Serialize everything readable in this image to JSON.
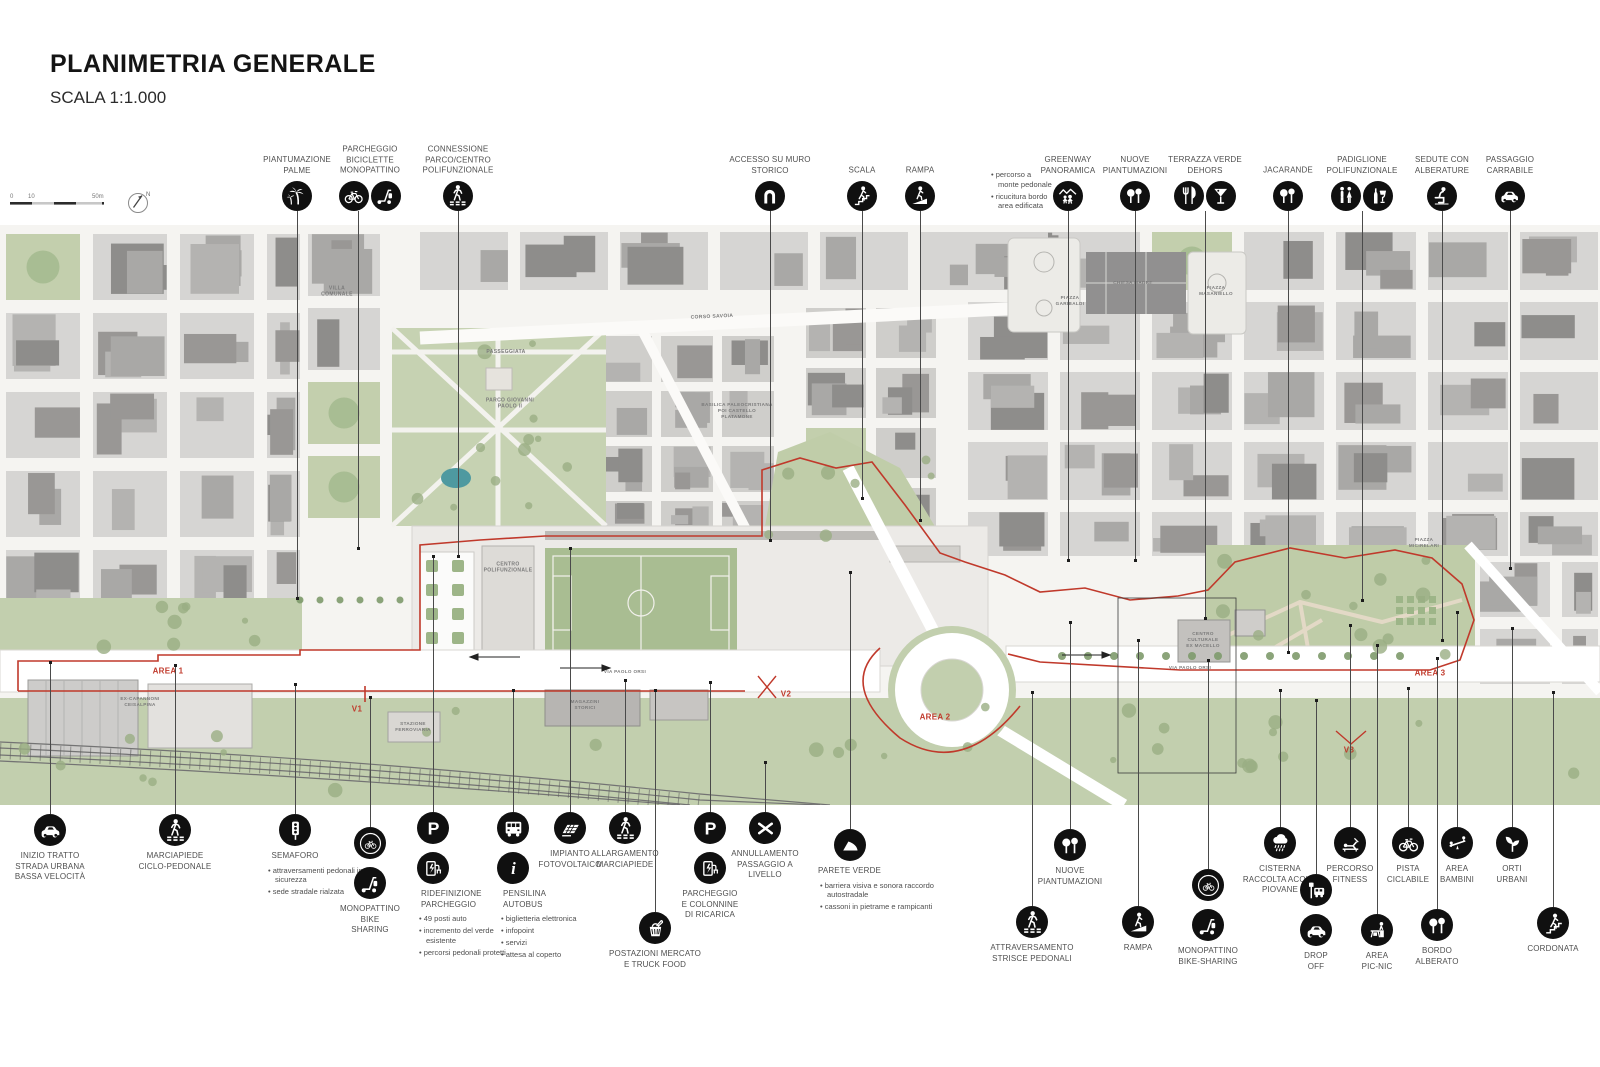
{
  "header": {
    "title": "PLANIMETRIA GENERALE",
    "subtitle": "SCALA 1:1.000"
  },
  "scalebar": {
    "ticks": [
      "0",
      "10",
      "50m"
    ],
    "north": "N"
  },
  "colors": {
    "accent_red": "#c0392b",
    "icon_background": "#101010",
    "map_green": "#c2cfae",
    "pond_teal": "#4e99a0"
  },
  "map_labels": [
    {
      "id": "villa-comunale",
      "text": "VILLA\nCOMUNALE",
      "x": 337,
      "y": 292,
      "size": 5
    },
    {
      "id": "passeggiata",
      "text": "PASSEGGIATA",
      "x": 506,
      "y": 352,
      "size": 5
    },
    {
      "id": "parco-giovanni-paolo",
      "text": "PARCO GIOVANNI\nPAOLO II",
      "x": 510,
      "y": 404,
      "size": 5
    },
    {
      "id": "corso-savoia",
      "text": "CORSO SAVOIA",
      "x": 712,
      "y": 317,
      "size": 5,
      "rotate": -2.5
    },
    {
      "id": "basilica-paleocristiana",
      "text": "BASILICA PALEOCRISTIANA\nPOI CASTELLO\nPLATAMONE",
      "x": 737,
      "y": 411,
      "size": 4.6
    },
    {
      "id": "piazza-garibaldi",
      "text": "PIAZZA\nGARIBALDI",
      "x": 1070,
      "y": 301,
      "size": 4.6
    },
    {
      "id": "chiesa-madre",
      "text": "CHIESA MADRE",
      "x": 1133,
      "y": 283,
      "size": 4.6
    },
    {
      "id": "piazza-masaniello",
      "text": "PIAZZA\nMASANIELLO",
      "x": 1216,
      "y": 291,
      "size": 4.6
    },
    {
      "id": "centro-polifunzionale",
      "text": "CENTRO\nPOLIFUNZIONALE",
      "x": 508,
      "y": 568,
      "size": 5
    },
    {
      "id": "via-paolo-orsi-ovest",
      "text": "VIA PAOLO ORSI",
      "x": 625,
      "y": 672,
      "size": 4.6
    },
    {
      "id": "via-paolo-orsi-est",
      "text": "VIA PAOLO ORSI",
      "x": 1190,
      "y": 668,
      "size": 4.6
    },
    {
      "id": "magazzini-storici",
      "text": "MAGAZZINI\nSTORICI",
      "x": 585,
      "y": 705,
      "size": 4.6
    },
    {
      "id": "stazione-ferroviaria",
      "text": "STAZIONE\nFERROVIARIA",
      "x": 413,
      "y": 727,
      "size": 4.6
    },
    {
      "id": "ex-capannoni",
      "text": "EX-CAPANNONI\nCEISALPINA",
      "x": 140,
      "y": 702,
      "size": 4.6
    },
    {
      "id": "centro-culturale-ex-macello",
      "text": "CENTRO\nCULTURALE\nEX MACELLO",
      "x": 1203,
      "y": 640,
      "size": 4.6
    },
    {
      "id": "piazza-micirelari",
      "text": "PIAZZA\nMICIRELARI",
      "x": 1424,
      "y": 543,
      "size": 4.6
    }
  ],
  "red_labels": [
    {
      "id": "area-1",
      "text": "AREA 1",
      "x": 168,
      "y": 671
    },
    {
      "id": "area-2",
      "text": "AREA 2",
      "x": 935,
      "y": 717
    },
    {
      "id": "area-3",
      "text": "AREA 3",
      "x": 1430,
      "y": 673
    },
    {
      "id": "v1",
      "text": "V1",
      "x": 357,
      "y": 709
    },
    {
      "id": "v2",
      "text": "V2",
      "x": 786,
      "y": 694
    },
    {
      "id": "v3",
      "text": "V3",
      "x": 1349,
      "y": 750
    }
  ],
  "callouts_top": [
    {
      "id": "piantumazione-palme",
      "label": "PIANTUMAZIONE\nPALME",
      "icons": [
        "palm"
      ],
      "x": 297,
      "line_to": 598
    },
    {
      "id": "parcheggio-biciclette-monopattino",
      "label": "PARCHEGGIO\nBICICLETTE\nMONOPATTINO",
      "icons": [
        "bike",
        "scooter"
      ],
      "x": 370,
      "lx": 358,
      "line_to": 548
    },
    {
      "id": "connessione-parco-centro",
      "label": "CONNESSIONE\nPARCO/CENTRO\nPOLIFUNZIONALE",
      "icons": [
        "crosswalk"
      ],
      "x": 458,
      "line_to": 556
    },
    {
      "id": "accesso-su-muro-storico",
      "label": "ACCESSO SU MURO\nSTORICO",
      "icons": [
        "arch"
      ],
      "x": 770,
      "line_to": 540
    },
    {
      "id": "scala",
      "label": "SCALA",
      "icons": [
        "stairs"
      ],
      "x": 862,
      "line_to": 498
    },
    {
      "id": "rampa",
      "label": "RAMPA",
      "icons": [
        "ramp"
      ],
      "x": 920,
      "line_to": 520
    },
    {
      "id": "greenway-panoramica",
      "label": "GREENWAY\nPANORAMICA",
      "icons": [
        "greenway"
      ],
      "x": 1068,
      "line_to": 560,
      "bullets": [
        "percorso a monte pedonale",
        "ricucitura bordo area edificata"
      ],
      "bullets_side": "left"
    },
    {
      "id": "nuove-piantumazioni-nord",
      "label": "NUOVE\nPIANTUMAZIONI",
      "icons": [
        "trees"
      ],
      "x": 1135,
      "line_to": 560
    },
    {
      "id": "terrazza-verde-dehors",
      "label": "TERRAZZA VERDE\nDEHORS",
      "icons": [
        "forkknife",
        "martini"
      ],
      "x": 1205,
      "line_to": 618
    },
    {
      "id": "jacarande",
      "label": "JACARANDE",
      "icons": [
        "trees"
      ],
      "x": 1288,
      "line_to": 652
    },
    {
      "id": "padiglione-polifunzionale",
      "label": "PADIGLIONE\nPOLIFUNZIONALE",
      "icons": [
        "wc",
        "bottleglass"
      ],
      "x": 1362,
      "line_to": 600
    },
    {
      "id": "sedute-con-alberature",
      "label": "SEDUTE CON\nALBERATURE",
      "icons": [
        "sit"
      ],
      "x": 1442,
      "line_to": 640
    },
    {
      "id": "passaggio-carrabile",
      "label": "PASSAGGIO\nCARRABILE",
      "icons": [
        "car"
      ],
      "x": 1510,
      "line_to": 568
    }
  ],
  "callouts_bottom": [
    {
      "id": "inizio-tratto-strada-urbana",
      "label": "INIZIO TRATTO\nSTRADA URBANA\nBASSA VELOCITÀ",
      "icons": [
        "car"
      ],
      "x": 50,
      "iy": 830,
      "line_from": 662
    },
    {
      "id": "marciapiede-ciclo-pedonale",
      "label": "MARCIAPIEDE\nCICLO-PEDONALE",
      "icons": [
        "crosswalk"
      ],
      "x": 175,
      "iy": 830,
      "line_from": 665
    },
    {
      "id": "semaforo",
      "label": "SEMAFORO",
      "icons": [
        "traffic"
      ],
      "x": 295,
      "iy": 830,
      "line_from": 684,
      "bullets": [
        "attraversamenti pedonali in sicurezza",
        "sede stradale rialzata"
      ],
      "bx": -27,
      "bw": 112
    },
    {
      "id": "monopattino-bike-sharing",
      "label": "MONOPATTINO\nBIKE\nSHARING",
      "icons": [
        "bikeshare",
        "scooter"
      ],
      "x": 370,
      "iy": 843,
      "line_from": 697
    },
    {
      "id": "ridefinizione-parcheggio",
      "label": "RIDEFINIZIONE\nPARCHEGGIO",
      "icons": [
        "parkP",
        "charge"
      ],
      "x": 433,
      "iy": 828,
      "line_from": 556,
      "align": "left",
      "ldx": -12,
      "bullets": [
        "49 posti auto",
        "incremento del verde esistente",
        "percorsi pedonali protetti"
      ],
      "bx": -14,
      "bw": 100
    },
    {
      "id": "pensilina-autobus",
      "label": "PENSILINA\nAUTOBUS",
      "icons": [
        "bus",
        "info"
      ],
      "x": 513,
      "iy": 828,
      "line_from": 690,
      "align": "left",
      "ldx": -10,
      "bullets": [
        "biglietteria elettronica",
        "infopoint",
        "servizi",
        "attesa al coperto"
      ],
      "bx": -12,
      "bw": 105
    },
    {
      "id": "impianto-fotovoltaico",
      "label": "IMPIANTO\nFOTOVOLTAICO",
      "icons": [
        "solar"
      ],
      "x": 570,
      "iy": 828,
      "line_from": 548
    },
    {
      "id": "allargamento-marciapiede",
      "label": "ALLARGAMENTO\nMARCIAPIEDE",
      "icons": [
        "crosswalk"
      ],
      "x": 625,
      "iy": 828,
      "line_from": 680
    },
    {
      "id": "postazioni-mercato-truck-food",
      "label": "POSTAZIONI MERCATO\nE TRUCK FOOD",
      "icons": [
        "basket"
      ],
      "x": 655,
      "iy": 928,
      "line_from": 690
    },
    {
      "id": "parcheggio-colonnine-ricarica",
      "label": "PARCHEGGIO\nE COLONNINE\nDI RICARICA",
      "icons": [
        "parkP",
        "charge"
      ],
      "x": 710,
      "iy": 828,
      "line_from": 682
    },
    {
      "id": "annullamento-passaggio-livello",
      "label": "ANNULLAMENTO\nPASSAGGIO A\nLIVELLO",
      "icons": [
        "crossx"
      ],
      "x": 765,
      "iy": 828,
      "line_from": 762
    },
    {
      "id": "parete-verde",
      "label": "PARETE VERDE",
      "icons": [
        "wedge"
      ],
      "x": 850,
      "iy": 845,
      "line_from": 572,
      "align": "left",
      "ldx": -32,
      "bullets": [
        "barriera visiva e sonora raccordo autostradale",
        "cassoni in pietrame e rampicanti"
      ],
      "bx": -30,
      "bw": 115
    },
    {
      "id": "nuove-piantumazioni-sud",
      "label": "NUOVE\nPIANTUMAZIONI",
      "icons": [
        "trees"
      ],
      "x": 1070,
      "iy": 845,
      "line_from": 622
    },
    {
      "id": "attraversamento-strisce-pedonali",
      "label": "ATTRAVERSAMENTO\nSTRISCE PEDONALI",
      "icons": [
        "crosswalk"
      ],
      "x": 1032,
      "iy": 922,
      "line_from": 692
    },
    {
      "id": "rampa-sud",
      "label": "RAMPA",
      "icons": [
        "ramp"
      ],
      "x": 1138,
      "iy": 922,
      "line_from": 640
    },
    {
      "id": "monopattino-bike-sharing-est",
      "label": "MONOPATTINO\nBIKE-SHARING",
      "icons": [
        "bikeshare",
        "scooter"
      ],
      "x": 1208,
      "iy": 885,
      "line_from": 660
    },
    {
      "id": "cisterna-raccolta-acque",
      "label": "CISTERNA\nRACCOLTA ACQUE\nPIOVANE",
      "icons": [
        "rain"
      ],
      "x": 1280,
      "iy": 843,
      "line_from": 690
    },
    {
      "id": "percorso-fitness",
      "label": "PERCORSO\nFITNESS",
      "icons": [
        "fitness"
      ],
      "x": 1350,
      "iy": 843,
      "line_from": 625
    },
    {
      "id": "pista-ciclabile",
      "label": "PISTA\nCICLABILE",
      "icons": [
        "bike"
      ],
      "x": 1408,
      "iy": 843,
      "line_from": 688
    },
    {
      "id": "area-bambini",
      "label": "AREA\nBAMBINI",
      "icons": [
        "seesaw"
      ],
      "x": 1457,
      "iy": 843,
      "line_from": 612
    },
    {
      "id": "orti-urbani",
      "label": "ORTI\nURBANI",
      "icons": [
        "sprout"
      ],
      "x": 1512,
      "iy": 843,
      "line_from": 628
    },
    {
      "id": "drop-off",
      "label": "DROP\nOFF",
      "icons": [
        "busstop",
        "car"
      ],
      "x": 1316,
      "iy": 890,
      "line_from": 700
    },
    {
      "id": "area-pic-nic",
      "label": "AREA\nPIC-NIC",
      "icons": [
        "picnic"
      ],
      "x": 1377,
      "iy": 930,
      "line_from": 645
    },
    {
      "id": "bordo-alberato",
      "label": "BORDO\nALBERATO",
      "icons": [
        "trees"
      ],
      "x": 1437,
      "iy": 925,
      "line_from": 658
    },
    {
      "id": "cordonata",
      "label": "CORDONATA",
      "icons": [
        "stairs"
      ],
      "x": 1553,
      "iy": 923,
      "line_from": 692
    }
  ]
}
